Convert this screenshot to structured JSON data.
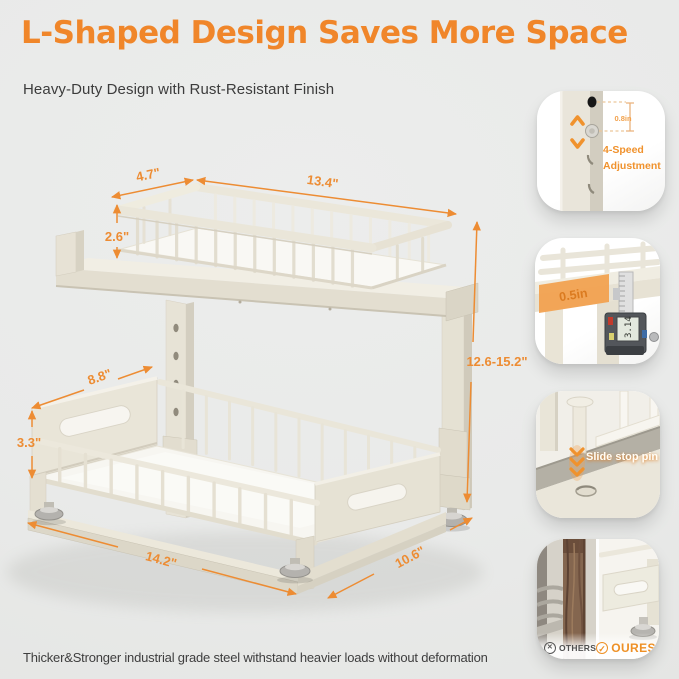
{
  "page": {
    "title": "L-Shaped Design Saves More Space",
    "subtitle": "Heavy-Duty Design with Rust-Resistant Finish",
    "footer_note": "Thicker&Stronger industrial grade steel withstand heavier loads without deformation"
  },
  "colors": {
    "accent_orange": "#F0862A",
    "dimension_orange": "#ED8C33",
    "background_gray": "#EAEAEA",
    "rack_cream": "#E8E4D7",
    "text_dark": "#3E3E3E"
  },
  "diagram": {
    "dimensions": {
      "top_basket_depth": "4.7\"",
      "top_basket_width": "13.4\"",
      "top_basket_height": "2.6\"",
      "lower_panel_depth": "8.8\"",
      "lower_panel_height": "3.3\"",
      "base_width": "14.2\"",
      "base_depth": "10.6\"",
      "overall_height": "12.6-15.2\""
    }
  },
  "callouts": {
    "adjustment": {
      "hole_spacing": "0.8in",
      "label": "4-Speed Adjustment"
    },
    "thickness": {
      "measure": "0.5in",
      "caliper_reading": "3.14"
    },
    "stop_pin": {
      "label": "Slide stop pin"
    },
    "comparison": {
      "others_label": "OTHERS",
      "ours_label": "OURES"
    }
  }
}
